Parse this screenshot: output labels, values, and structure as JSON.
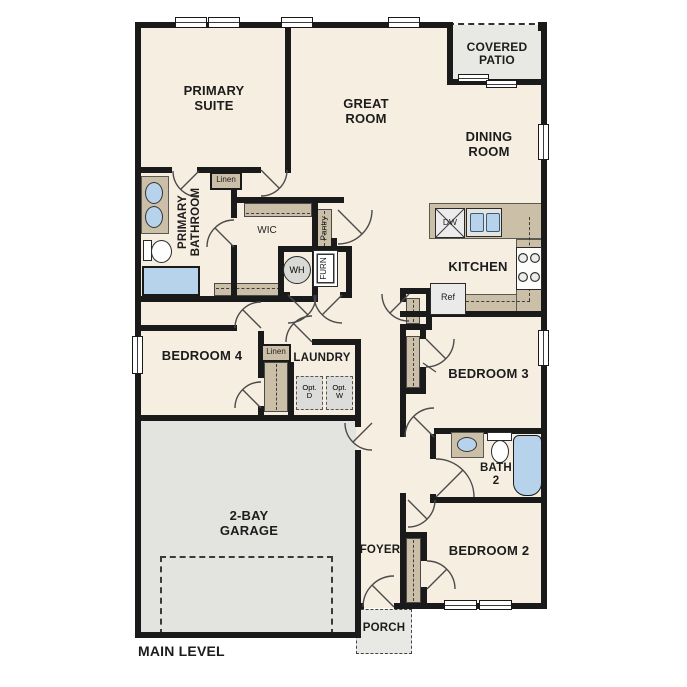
{
  "title": "MAIN LEVEL",
  "colors": {
    "floor": "#f6eee1",
    "wall": "#1a1a1a",
    "counter": "#cbbfa8",
    "garage": "#e3e3e0",
    "outdoor": "#e8e8e5",
    "fixture_blue": "#b7d3ec",
    "appliance": "#ececec"
  },
  "rooms": {
    "primary_suite": {
      "label": "PRIMARY\nSUITE"
    },
    "great_room": {
      "label": "GREAT\nROOM"
    },
    "covered_patio": {
      "label": "COVERED\nPATIO"
    },
    "dining_room": {
      "label": "DINING\nROOM"
    },
    "kitchen": {
      "label": "KITCHEN"
    },
    "primary_bathroom": {
      "label": "PRIMARY\nBATHROOM"
    },
    "wic": {
      "label": "WIC"
    },
    "bedroom4": {
      "label": "BEDROOM 4"
    },
    "laundry": {
      "label": "LAUNDRY"
    },
    "bedroom3": {
      "label": "BEDROOM 3"
    },
    "bath2": {
      "label": "BATH\n2"
    },
    "bedroom2": {
      "label": "BEDROOM 2"
    },
    "foyer": {
      "label": "FOYER"
    },
    "porch": {
      "label": "PORCH"
    },
    "garage": {
      "label": "2-BAY\nGARAGE"
    }
  },
  "closets": {
    "linen_upper": "Linen",
    "linen_hall": "Linen",
    "pantry": "Pantry"
  },
  "appliances": {
    "dishwasher": "DW",
    "refrigerator": "Ref",
    "water_heater": "WH",
    "furnace": "FURN",
    "opt_dryer": "Opt.\nD",
    "opt_washer": "Opt.\nW"
  }
}
